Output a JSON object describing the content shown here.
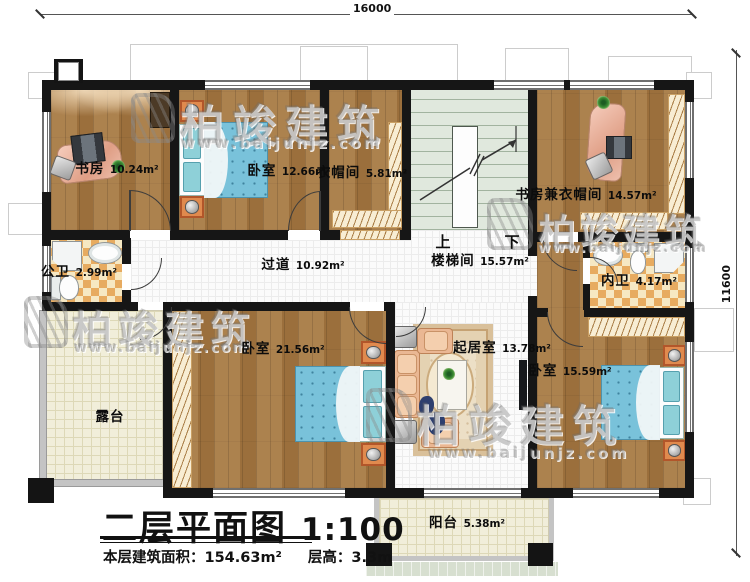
{
  "dimensions": {
    "top": "16000",
    "right": "11600"
  },
  "rooms": {
    "study": {
      "name": "书房",
      "area": "10.24m²"
    },
    "bedroom1": {
      "name": "卧室",
      "area": "12.66m²"
    },
    "cloakroom": {
      "name": "衣帽间",
      "area": "5.81m²"
    },
    "stairwell": {
      "name": "楼梯间",
      "area": "15.57m²"
    },
    "study2": {
      "name": "书房兼衣帽间",
      "area": "14.57m²"
    },
    "public_bath": {
      "name": "公卫",
      "area": "2.99m²"
    },
    "hallway": {
      "name": "过道",
      "area": "10.92m²"
    },
    "inner_bath": {
      "name": "内卫",
      "area": "4.17m²"
    },
    "terrace": {
      "name": "露台"
    },
    "bedroom2": {
      "name": "卧室",
      "area": "21.56m²"
    },
    "living": {
      "name": "起居室",
      "area": "13.78m²"
    },
    "bedroom3": {
      "name": "卧室",
      "area": "15.59m²"
    },
    "balcony": {
      "name": "阳台",
      "area": "5.38m²"
    }
  },
  "stairs": {
    "up": "上",
    "down": "下"
  },
  "title": {
    "main": "二层平面图",
    "scale": "1:100",
    "floor_area": "本层建筑面积：154.63m²",
    "floor_height": "层高：3.3m"
  },
  "watermark": {
    "brand": "柏竣建筑",
    "url": "www.baijunjz.com"
  },
  "colors": {
    "wall": "#161616",
    "wood_floor": "#a3753f",
    "stair_floor": "#e0e8dd",
    "bath_tile_a": "#e7ab60",
    "bath_tile_b": "#f6e8c3",
    "bed_blue": "#79c2da",
    "desk_pink": "#e8ab95",
    "terrace_tile": "#f1eeda"
  }
}
